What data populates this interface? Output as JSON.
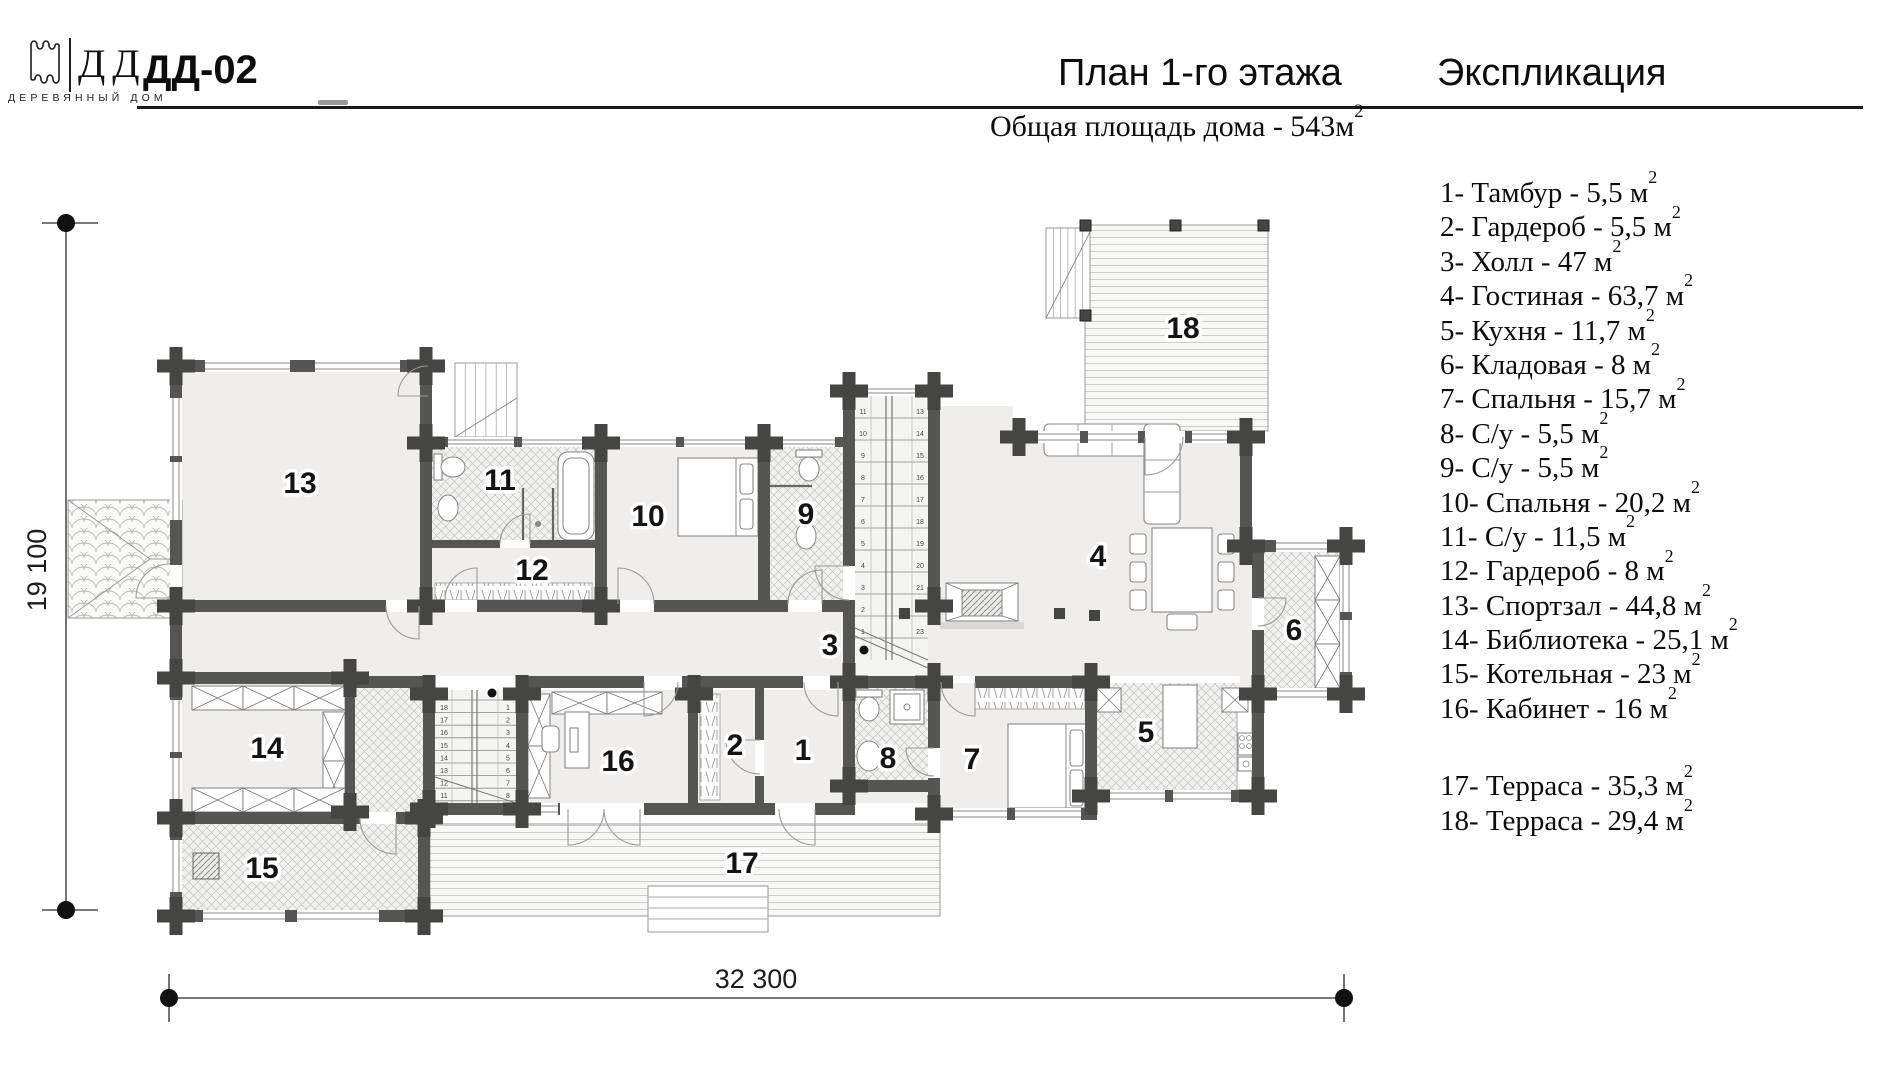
{
  "header": {
    "logo": {
      "abbr": "ДД",
      "caption": "ДЕРЕВЯННЫЙ ДОМ"
    },
    "project_code": "ДД-02",
    "plan_title": "План 1-го этажа",
    "explication_title": "Экспликация",
    "subtitle": {
      "text": "Общая площадь дома - 543м",
      "sup": "2"
    }
  },
  "legend": {
    "items": [
      {
        "text": "1- Тамбур - 5,5 м",
        "sup": "2"
      },
      {
        "text": "2- Гардероб - 5,5 м",
        "sup": "2"
      },
      {
        "text": "3- Холл - 47 м",
        "sup": "2"
      },
      {
        "text": "4- Гостиная - 63,7 м",
        "sup": "2"
      },
      {
        "text": "5- Кухня - 11,7 м",
        "sup": "2"
      },
      {
        "text": "6- Кладовая - 8 м",
        "sup": "2"
      },
      {
        "text": "7- Спальня - 15,7 м",
        "sup": "2"
      },
      {
        "text": "8- С/у - 5,5 м",
        "sup": "2"
      },
      {
        "text": "9- С/у - 5,5 м",
        "sup": "2"
      },
      {
        "text": "10- Спальня - 20,2 м",
        "sup": "2"
      },
      {
        "text": "11- С/у - 11,5 м",
        "sup": "2"
      },
      {
        "text": "12- Гардероб - 8 м",
        "sup": "2"
      },
      {
        "text": "13- Спортзал - 44,8 м",
        "sup": "2"
      },
      {
        "text": "14- Библиотека - 25,1 м",
        "sup": "2"
      },
      {
        "text": "15- Котельная - 23 м",
        "sup": "2"
      },
      {
        "text": "16- Кабинет - 16 м",
        "sup": "2"
      },
      {
        "text": "17- Терраса - 35,3 м",
        "sup": "2"
      },
      {
        "text": "18- Терраса - 29,4 м",
        "sup": "2"
      }
    ]
  },
  "plan": {
    "dimensions": {
      "width_label": "32 300",
      "height_label": "19 100"
    },
    "room_numbers": {
      "r1": "1",
      "r2": "2",
      "r3": "3",
      "r4": "4",
      "r5": "5",
      "r6": "6",
      "r7": "7",
      "r8": "8",
      "r9": "9",
      "r10": "10",
      "r11": "11",
      "r12": "12",
      "r13": "13",
      "r14": "14",
      "r15": "15",
      "r16": "16",
      "r17": "17",
      "r18": "18"
    },
    "stairs": {
      "upper_left": [
        "11",
        "10",
        "9",
        "8",
        "7",
        "6",
        "5",
        "4",
        "3",
        "2",
        "1"
      ],
      "upper_right": [
        "13",
        "14",
        "15",
        "16",
        "17",
        "18",
        "19",
        "20",
        "21",
        "22",
        "23"
      ],
      "lower_left": [
        "18",
        "17",
        "16",
        "15",
        "14",
        "13",
        "12",
        "11",
        "10"
      ],
      "lower_right": [
        "1",
        "2",
        "3",
        "4",
        "5",
        "6",
        "7",
        "8"
      ]
    }
  }
}
